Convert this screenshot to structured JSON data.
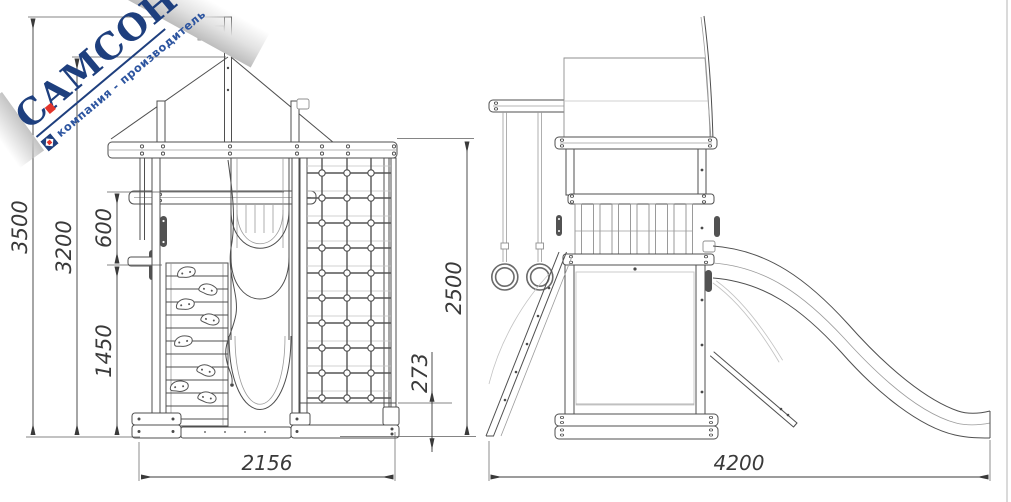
{
  "logo": {
    "brand": "САМСОН",
    "tagline": "компания - производитель",
    "brand_color": "#1e3f7e",
    "accent_red": "#e2342b"
  },
  "dimensions": {
    "front": {
      "total_height": "3500",
      "roof_peak_height": "3200",
      "rail_to_platform": "600",
      "platform_height": "1450",
      "net_ground_clearance": "273",
      "base_width": "2156",
      "beam_height": "2500"
    },
    "side": {
      "total_length": "4200"
    }
  },
  "colors": {
    "line": "#4f4f4f",
    "dim_text": "#3a3a3a",
    "corner_gray": "#c4c4c4"
  }
}
